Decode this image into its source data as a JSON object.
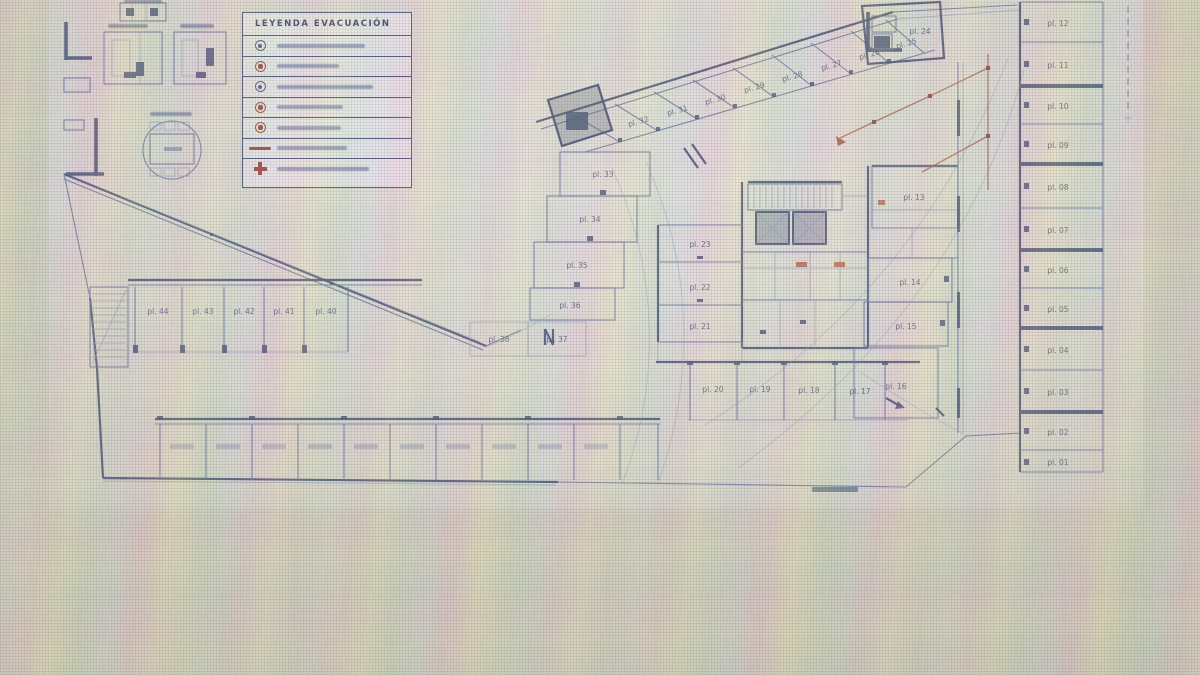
{
  "legend": {
    "title": "LEYENDA EVACUACIÓN",
    "rows": [
      {
        "icon": "circle-symbol"
      },
      {
        "icon": "red-circle-symbol"
      },
      {
        "icon": "circle-symbol"
      },
      {
        "icon": "red-circle-symbol"
      },
      {
        "icon": "red-circle-symbol"
      },
      {
        "icon": "red-line-symbol"
      },
      {
        "icon": "red-cross-symbol"
      }
    ]
  },
  "plan": {
    "stalls": {
      "right_column": [
        "pl. 12",
        "pl. 11",
        "pl. 10",
        "pl. 09",
        "pl. 08",
        "pl. 07",
        "pl. 06",
        "pl. 05",
        "pl. 04",
        "pl. 03",
        "pl. 02",
        "pl. 01"
      ],
      "diagonal_band": [
        "pl. 32",
        "pl. 31",
        "pl. 30",
        "pl. 29",
        "pl. 28",
        "pl. 27",
        "pl. 26",
        "pl. 25"
      ],
      "corner_stall": "pl. 24",
      "mid_column": [
        "pl. 23",
        "pl. 22",
        "pl. 21"
      ],
      "bottom_row": [
        "pl. 20",
        "pl. 19",
        "pl. 18",
        "pl. 17"
      ],
      "steps_column": [
        "pl. 33",
        "pl. 34",
        "pl. 35",
        "pl. 36"
      ],
      "under_steps": [
        "pl. 38",
        "pl. 37"
      ],
      "left_row": [
        "pl. 44",
        "pl. 43",
        "pl. 42",
        "pl. 41",
        "pl. 40"
      ],
      "core_right_column": [
        "pl. 13",
        "pl. 14",
        "pl. 15",
        "pl. 16"
      ]
    }
  },
  "colors": {
    "line_blue": "#5a68a0",
    "wall_navy": "#2e3c6a",
    "red_symbol": "#8d3526",
    "route_red": "#a8503a",
    "paper": "#f0eff4",
    "photo_background": "#d3cdbc"
  }
}
